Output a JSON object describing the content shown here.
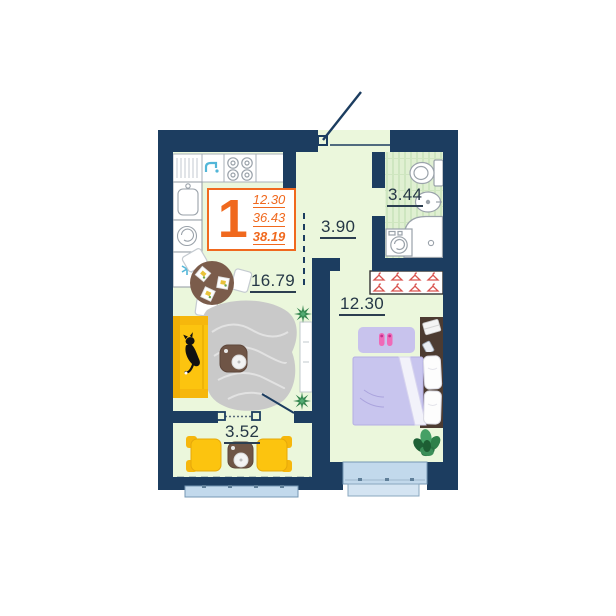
{
  "unit_badge": {
    "rooms_count": "1",
    "stats": [
      "12.30",
      "36.43",
      "38.19"
    ]
  },
  "room_labels": {
    "kitchen_living": "16.79",
    "hallway": "3.90",
    "bathroom": "3.44",
    "bedroom": "12.30",
    "balcony": "3.52"
  },
  "colors": {
    "wall": "#1c3d60",
    "floor": "#ebf7dc",
    "accent_orange": "#f0691e",
    "sofa_yellow": "#fcc40f",
    "bed_lavender": "#c8c5ee",
    "furniture_brown": "#6f5546",
    "glazing_blue": "#c2d9ec",
    "hanger_red": "#d9534f",
    "plant_green": "#2e8049",
    "slipper_pink": "#ef6ab8"
  },
  "icons": {
    "faucet": "faucet-icon",
    "stove": "stove-burners-icon",
    "snowflake": "snowflake-icon",
    "washing_machine": "washing-machine-icon",
    "hanger": "hanger-icon",
    "cat": "cat-icon",
    "plant": "plant-icon"
  }
}
